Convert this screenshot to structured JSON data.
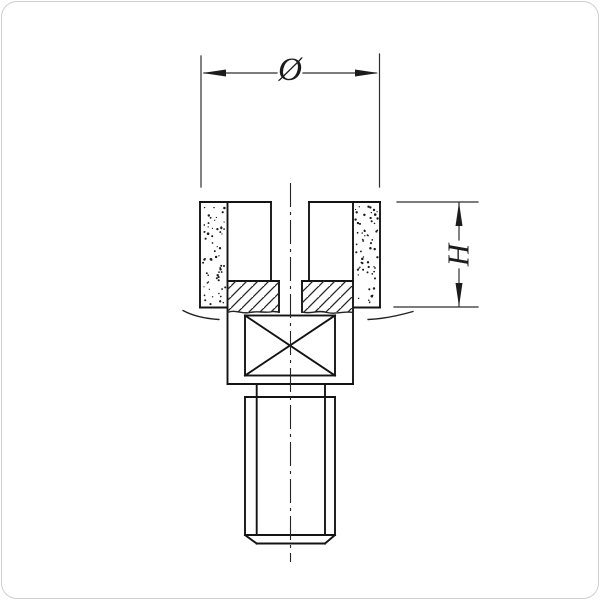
{
  "labels": {
    "diameter": "Ø",
    "height": "H"
  },
  "dimensions_shown": {
    "diameter_symbol_meaning": "outer diameter of cup wheel",
    "height_letter_meaning": "abrasive segment height"
  },
  "colors": {
    "background": "#ffffff",
    "outline_ink": "#141414",
    "thin_ink": "#2e2e2e",
    "frame_border": "#cfcfcf"
  }
}
